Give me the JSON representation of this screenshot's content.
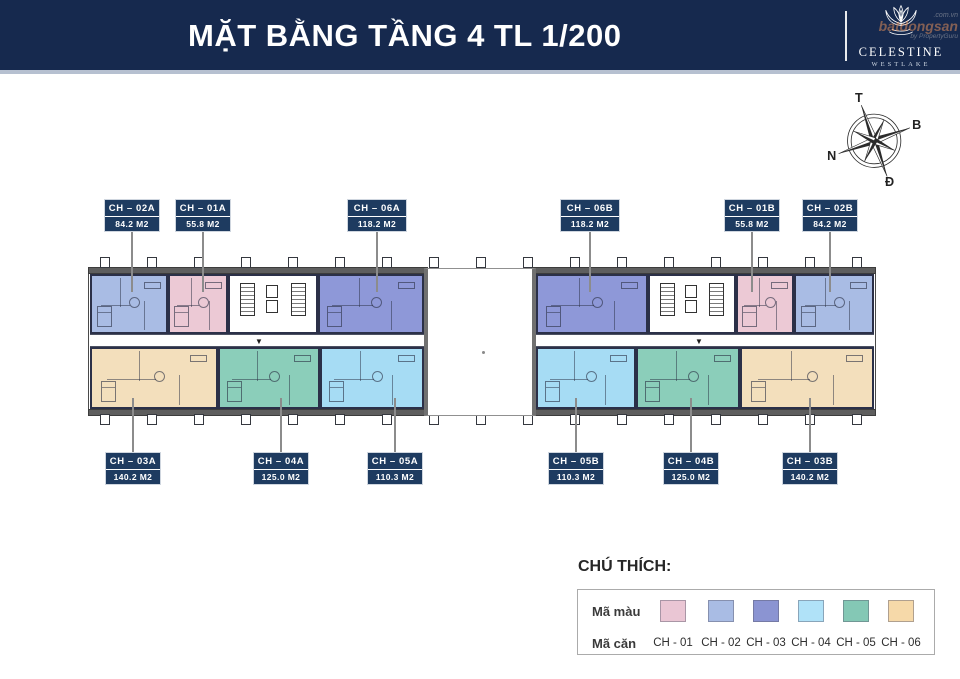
{
  "header": {
    "title": "MẶT BẰNG TẦNG 4 TL 1/200",
    "brand_name": "CELESTINE",
    "brand_sub": "WESTLAKE",
    "watermark": {
      "line1": ".com.vn",
      "line2a": "bat",
      "line2b": "dongsan",
      "line3": "by PropertyGuru"
    }
  },
  "compass": {
    "top": "T",
    "right": "B",
    "left": "N",
    "bottom": "Đ"
  },
  "colors": {
    "header_bg": "#16294e",
    "label_bg": "#1e3b60",
    "wall": "#2b3048",
    "band": "#5e5e5e",
    "leader": "#8c8c8c",
    "pink": "#ecc9d5",
    "periwinkle": "#a9bce4",
    "purple": "#8e98d8",
    "lightblue": "#a6dcf4",
    "teal": "#8bceba",
    "cream": "#f3dfbc"
  },
  "plan": {
    "wings": [
      {
        "x": 88,
        "y": 267,
        "w": 340,
        "h": 149
      },
      {
        "x": 532,
        "y": 267,
        "w": 344,
        "h": 149
      }
    ],
    "bands": [
      {
        "x": 88,
        "y": 267,
        "w": 340,
        "h": 7
      },
      {
        "x": 532,
        "y": 267,
        "w": 344,
        "h": 7
      },
      {
        "x": 88,
        "y": 409,
        "w": 340,
        "h": 7
      },
      {
        "x": 532,
        "y": 409,
        "w": 344,
        "h": 7
      }
    ],
    "corridors": [
      {
        "x": 90,
        "y": 334,
        "w": 334,
        "h": 13
      },
      {
        "x": 536,
        "y": 334,
        "w": 338,
        "h": 13
      }
    ],
    "void": {
      "x": 424,
      "y": 268,
      "w": 112,
      "h": 148
    },
    "ticks": {
      "start": 100,
      "end": 852,
      "step": 47,
      "top_y": 257,
      "bottom_y": 414
    },
    "section_arrows": [
      {
        "x": 255,
        "y": 338
      },
      {
        "x": 695,
        "y": 338
      }
    ],
    "cores": [
      {
        "x": 228,
        "y": 274,
        "w": 90,
        "h": 60
      },
      {
        "x": 648,
        "y": 274,
        "w": 88,
        "h": 60
      }
    ],
    "units": [
      {
        "code": "CH-02A",
        "color": "periwinkle",
        "x": 90,
        "y": 274,
        "w": 78,
        "h": 60
      },
      {
        "code": "CH-01A",
        "color": "pink",
        "x": 168,
        "y": 274,
        "w": 60,
        "h": 60
      },
      {
        "code": "CH-06A",
        "color": "purple",
        "x": 318,
        "y": 274,
        "w": 106,
        "h": 60
      },
      {
        "code": "CH-06B",
        "color": "purple",
        "x": 536,
        "y": 274,
        "w": 112,
        "h": 60
      },
      {
        "code": "CH-01B",
        "color": "pink",
        "x": 736,
        "y": 274,
        "w": 58,
        "h": 60
      },
      {
        "code": "CH-02B",
        "color": "periwinkle",
        "x": 794,
        "y": 274,
        "w": 80,
        "h": 60
      },
      {
        "code": "CH-03A",
        "color": "cream",
        "x": 90,
        "y": 347,
        "w": 128,
        "h": 62
      },
      {
        "code": "CH-04A",
        "color": "teal",
        "x": 218,
        "y": 347,
        "w": 102,
        "h": 62
      },
      {
        "code": "CH-05A",
        "color": "lightblue",
        "x": 320,
        "y": 347,
        "w": 104,
        "h": 62
      },
      {
        "code": "CH-05B",
        "color": "lightblue",
        "x": 536,
        "y": 347,
        "w": 100,
        "h": 62
      },
      {
        "code": "CH-04B",
        "color": "teal",
        "x": 636,
        "y": 347,
        "w": 104,
        "h": 62
      },
      {
        "code": "CH-03B",
        "color": "cream",
        "x": 740,
        "y": 347,
        "w": 134,
        "h": 62
      }
    ],
    "labels_top": [
      {
        "code": "CH – 02A",
        "area": "84.2 M2",
        "x": 104,
        "w": 56
      },
      {
        "code": "CH – 01A",
        "area": "55.8 M2",
        "x": 175,
        "w": 56
      },
      {
        "code": "CH – 06A",
        "area": "118.2 M2",
        "x": 347,
        "w": 60
      },
      {
        "code": "CH – 06B",
        "area": "118.2 M2",
        "x": 560,
        "w": 60
      },
      {
        "code": "CH – 01B",
        "area": "55.8 M2",
        "x": 724,
        "w": 56
      },
      {
        "code": "CH – 02B",
        "area": "84.2 M2",
        "x": 802,
        "w": 56
      }
    ],
    "labels_bottom": [
      {
        "code": "CH – 03A",
        "area": "140.2 M2",
        "x": 105,
        "w": 56
      },
      {
        "code": "CH – 04A",
        "area": "125.0 M2",
        "x": 253,
        "w": 56
      },
      {
        "code": "CH – 05A",
        "area": "110.3 M2",
        "x": 367,
        "w": 56
      },
      {
        "code": "CH – 05B",
        "area": "110.3 M2",
        "x": 548,
        "w": 56
      },
      {
        "code": "CH – 04B",
        "area": "125.0 M2",
        "x": 663,
        "w": 56
      },
      {
        "code": "CH – 03B",
        "area": "140.2 M2",
        "x": 782,
        "w": 56
      }
    ],
    "label_top_y": 199,
    "label_bottom_y": 452
  },
  "legend": {
    "title": "CHÚ THÍCH:",
    "row1_label": "Mã màu",
    "row2_label": "Mã căn",
    "items": [
      {
        "code": "CH - 01",
        "color": "#eac6d4",
        "x": 660
      },
      {
        "code": "CH - 02",
        "color": "#a9bce4",
        "x": 708
      },
      {
        "code": "CH - 03",
        "color": "#8b94d2",
        "x": 753
      },
      {
        "code": "CH - 04",
        "color": "#b0e2f8",
        "x": 798
      },
      {
        "code": "CH - 05",
        "color": "#84c8b5",
        "x": 843
      },
      {
        "code": "CH - 06",
        "color": "#f6d9a9",
        "x": 888
      }
    ]
  }
}
